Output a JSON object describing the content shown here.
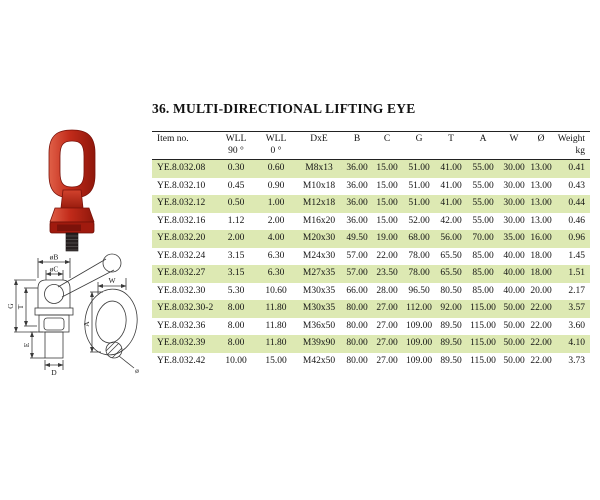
{
  "page": {
    "title": "36. MULTI-DIRECTIONAL LIFTING EYE"
  },
  "table": {
    "columns": [
      {
        "key": "item-no",
        "label": "Item no.",
        "sub": ""
      },
      {
        "key": "wll-90",
        "label": "WLL",
        "sub": "90 °"
      },
      {
        "key": "wll-0",
        "label": "WLL",
        "sub": "0 °"
      },
      {
        "key": "dxe",
        "label": "DxE",
        "sub": ""
      },
      {
        "key": "b",
        "label": "B",
        "sub": ""
      },
      {
        "key": "c",
        "label": "C",
        "sub": ""
      },
      {
        "key": "g",
        "label": "G",
        "sub": ""
      },
      {
        "key": "t",
        "label": "T",
        "sub": ""
      },
      {
        "key": "a",
        "label": "A",
        "sub": ""
      },
      {
        "key": "w",
        "label": "W",
        "sub": ""
      },
      {
        "key": "dia",
        "label": "Ø",
        "sub": ""
      },
      {
        "key": "weight",
        "label": "Weight",
        "sub": "kg"
      }
    ],
    "rows": [
      [
        "YE.8.032.08",
        "0.30",
        "0.60",
        "M8x13",
        "36.00",
        "15.00",
        "51.00",
        "41.00",
        "55.00",
        "30.00",
        "13.00",
        "0.41"
      ],
      [
        "YE.8.032.10",
        "0.45",
        "0.90",
        "M10x18",
        "36.00",
        "15.00",
        "51.00",
        "41.00",
        "55.00",
        "30.00",
        "13.00",
        "0.43"
      ],
      [
        "YE.8.032.12",
        "0.50",
        "1.00",
        "M12x18",
        "36.00",
        "15.00",
        "51.00",
        "41.00",
        "55.00",
        "30.00",
        "13.00",
        "0.44"
      ],
      [
        "YE.8.032.16",
        "1.12",
        "2.00",
        "M16x20",
        "36.00",
        "15.00",
        "52.00",
        "42.00",
        "55.00",
        "30.00",
        "13.00",
        "0.46"
      ],
      [
        "YE.8.032.20",
        "2.00",
        "4.00",
        "M20x30",
        "49.50",
        "19.00",
        "68.00",
        "56.00",
        "70.00",
        "35.00",
        "16.00",
        "0.96"
      ],
      [
        "YE.8.032.24",
        "3.15",
        "6.30",
        "M24x30",
        "57.00",
        "22.00",
        "78.00",
        "65.50",
        "85.00",
        "40.00",
        "18.00",
        "1.45"
      ],
      [
        "YE.8.032.27",
        "3.15",
        "6.30",
        "M27x35",
        "57.00",
        "23.50",
        "78.00",
        "65.50",
        "85.00",
        "40.00",
        "18.00",
        "1.51"
      ],
      [
        "YE.8.032.30",
        "5.30",
        "10.60",
        "M30x35",
        "66.00",
        "28.00",
        "96.50",
        "80.50",
        "85.00",
        "40.00",
        "20.00",
        "2.17"
      ],
      [
        "YE.8.032.30-2",
        "8.00",
        "11.80",
        "M30x35",
        "80.00",
        "27.00",
        "112.00",
        "92.00",
        "115.00",
        "50.00",
        "22.00",
        "3.57"
      ],
      [
        "YE.8.032.36",
        "8.00",
        "11.80",
        "M36x50",
        "80.00",
        "27.00",
        "109.00",
        "89.50",
        "115.00",
        "50.00",
        "22.00",
        "3.60"
      ],
      [
        "YE.8.032.39",
        "8.00",
        "11.80",
        "M39x90",
        "80.00",
        "27.00",
        "109.00",
        "89.50",
        "115.00",
        "50.00",
        "22.00",
        "4.10"
      ],
      [
        "YE.8.032.42",
        "10.00",
        "15.00",
        "M42x50",
        "80.00",
        "27.00",
        "109.00",
        "89.50",
        "115.00",
        "50.00",
        "22.00",
        "3.73"
      ]
    ]
  },
  "diagram": {
    "labels": {
      "ob": "øB",
      "oc": "øC",
      "g": "G",
      "t": "T",
      "e": "E",
      "d": "D",
      "w": "W",
      "a": "A",
      "dia": "ø"
    }
  },
  "colors": {
    "row_stripe": "#dde9b3",
    "product_red": "#c22b1a",
    "product_red_dark": "#8f170b",
    "product_red_light": "#e06048",
    "line": "#3a3a3a"
  }
}
